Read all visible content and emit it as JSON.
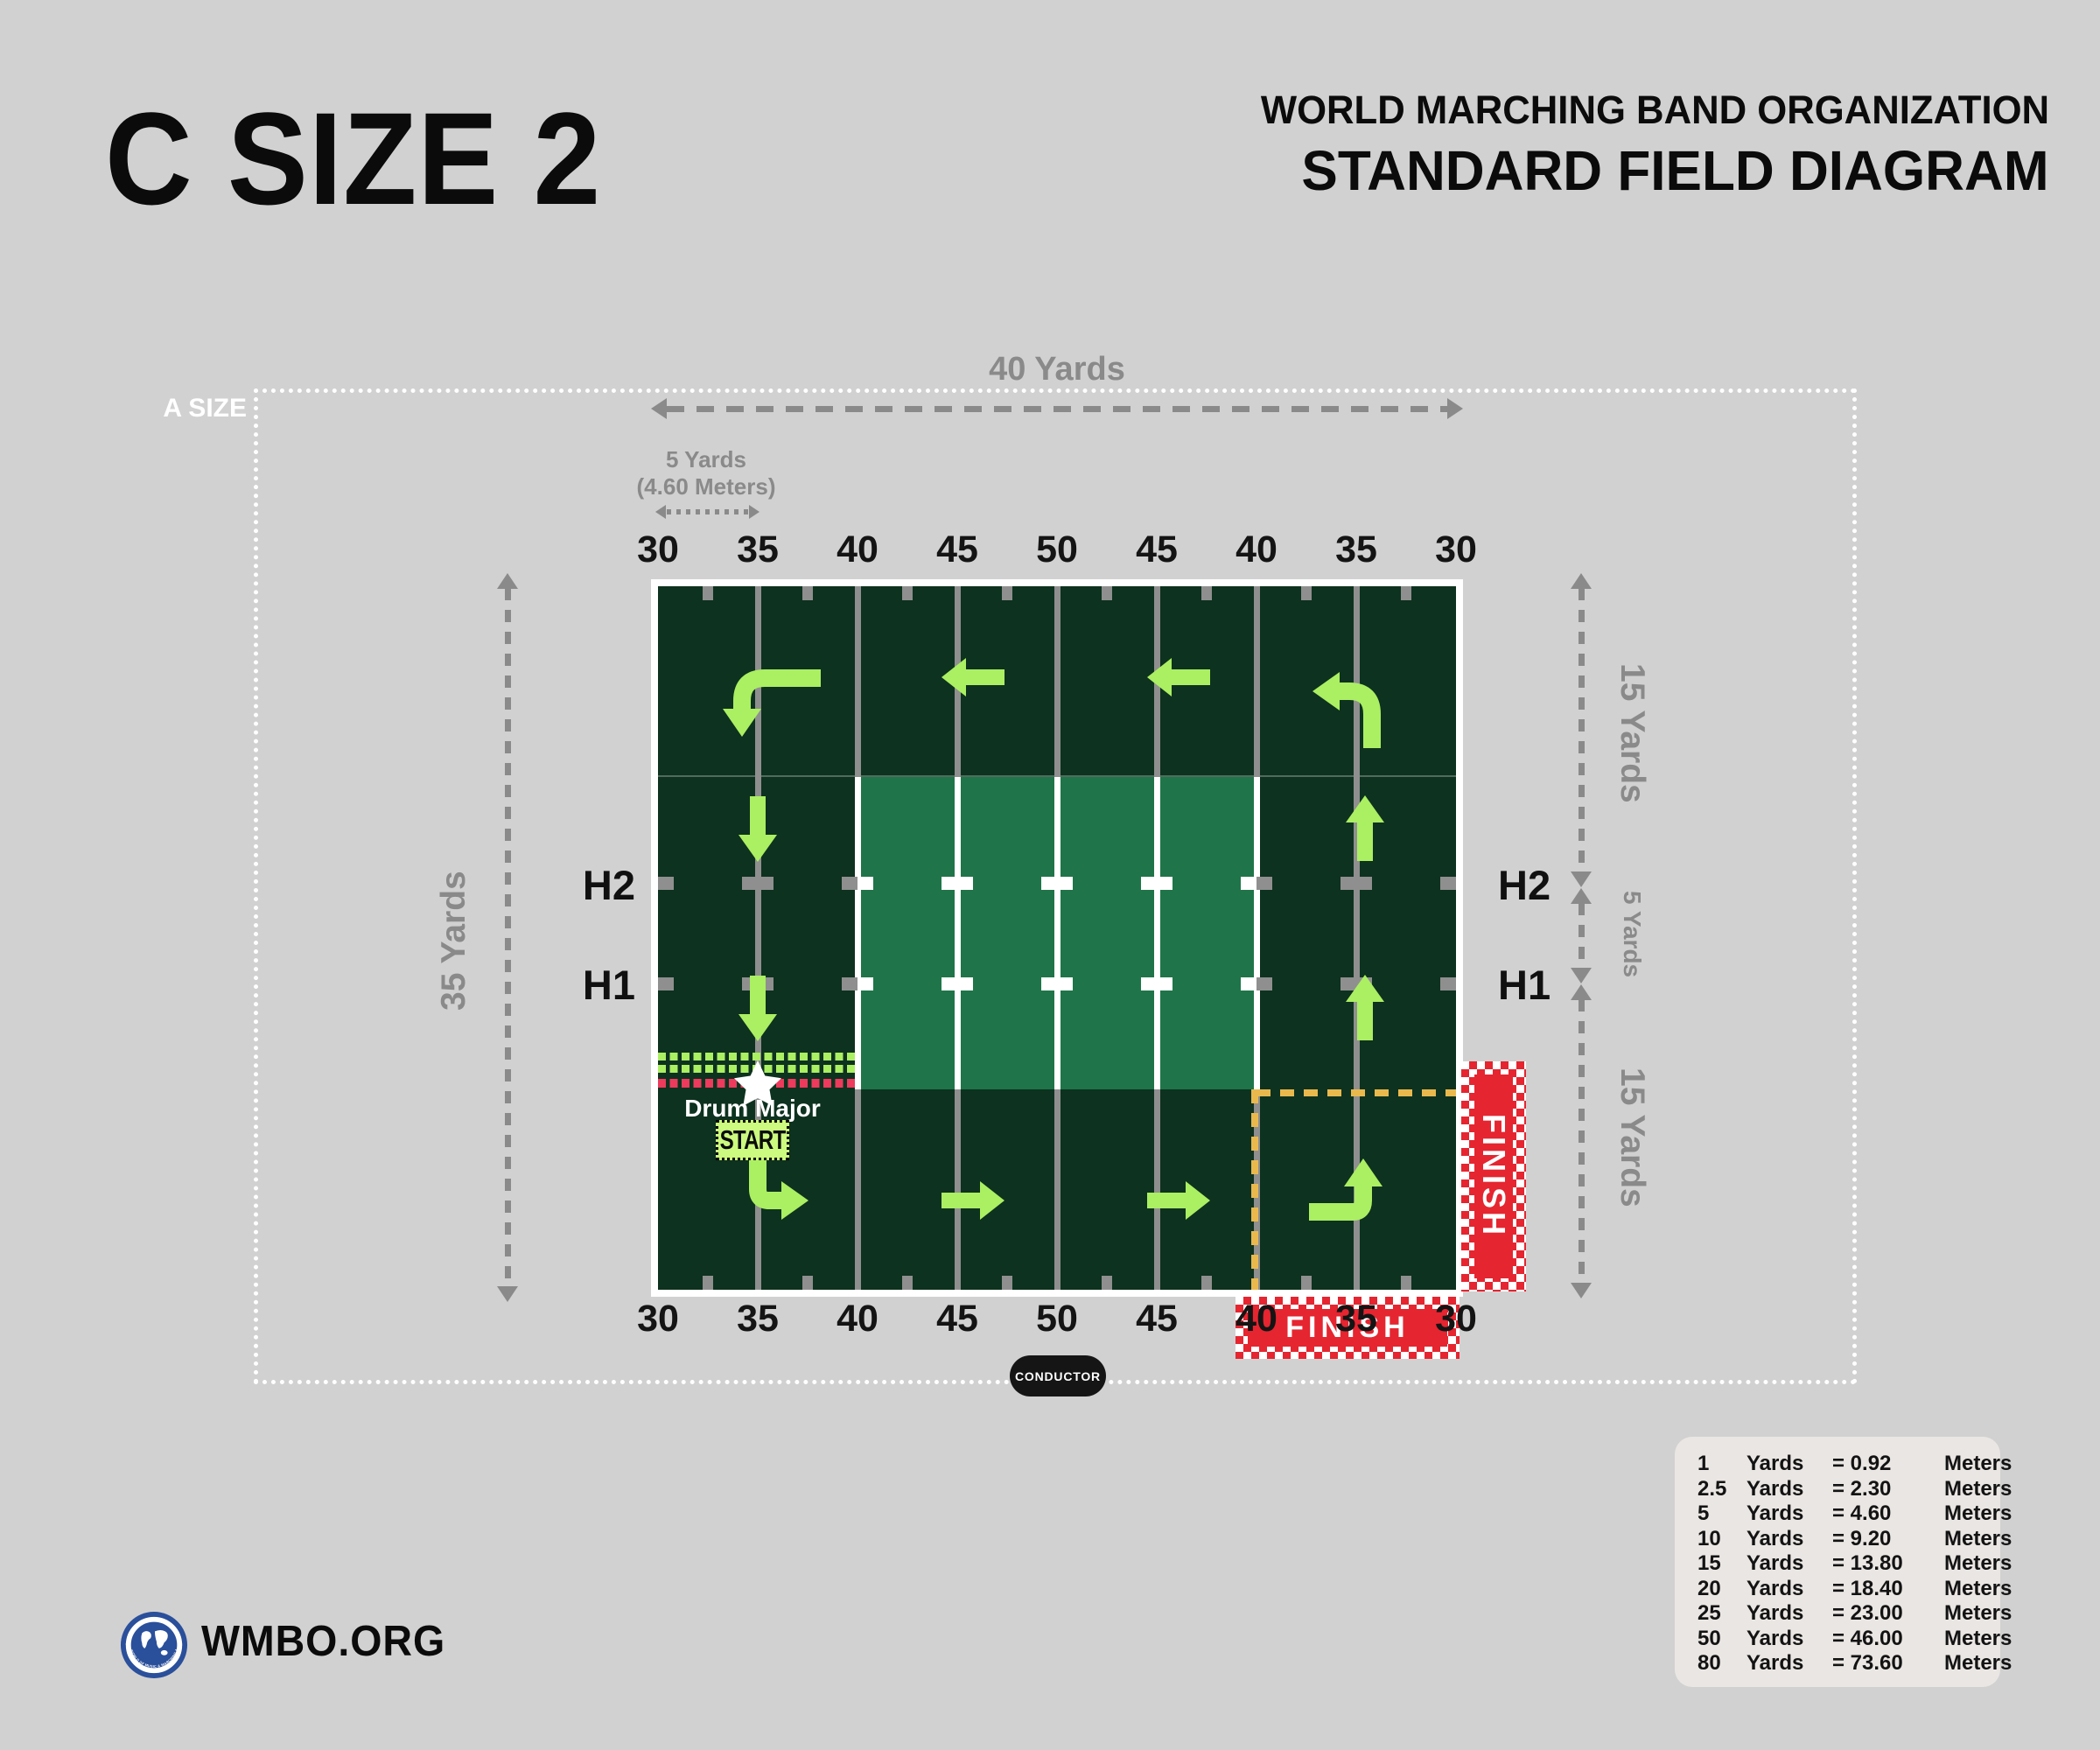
{
  "header": {
    "title": "C SIZE 2",
    "org_line1": "WORLD MARCHING BAND ORGANIZATION",
    "org_line2": "STANDARD FIELD DIAGRAM"
  },
  "a_size_label": "A SIZE",
  "measurements": {
    "top_width": "40 Yards",
    "five_yards_line1": "5 Yards",
    "five_yards_line2": "(4.60 Meters)",
    "left_height": "35 Yards",
    "right_top": "15 Yards",
    "right_mid": "5 Yards",
    "right_bottom": "15 Yards"
  },
  "field": {
    "yard_numbers_top": [
      "30",
      "35",
      "40",
      "45",
      "50",
      "45",
      "40",
      "35",
      "30"
    ],
    "yard_numbers_bottom": [
      "30",
      "35",
      "40",
      "45",
      "50",
      "45",
      "40",
      "35",
      "30"
    ],
    "hash_labels": {
      "left_h2": "H2",
      "left_h1": "H1",
      "right_h2": "H2",
      "right_h1": "H1"
    },
    "drum_major_label": "Drum Major",
    "start_label": "START",
    "finish_side_label": "FINISH",
    "finish_bottom_label": "FINISH",
    "conductor_label": "CONDUCTOR"
  },
  "conversion_table": {
    "rows": [
      {
        "n": "1",
        "u": "Yards",
        "v": "= 0.92",
        "m": "Meters"
      },
      {
        "n": "2.5",
        "u": "Yards",
        "v": "= 2.30",
        "m": "Meters"
      },
      {
        "n": "5",
        "u": "Yards",
        "v": "= 4.60",
        "m": "Meters"
      },
      {
        "n": "10",
        "u": "Yards",
        "v": "= 9.20",
        "m": "Meters"
      },
      {
        "n": "15",
        "u": "Yards",
        "v": "= 13.80",
        "m": "Meters"
      },
      {
        "n": "20",
        "u": "Yards",
        "v": "= 18.40",
        "m": "Meters"
      },
      {
        "n": "25",
        "u": "Yards",
        "v": "= 23.00",
        "m": "Meters"
      },
      {
        "n": "50",
        "u": "Yards",
        "v": "= 46.00",
        "m": "Meters"
      },
      {
        "n": "80",
        "u": "Yards",
        "v": "= 73.60",
        "m": "Meters"
      }
    ]
  },
  "footer": {
    "site": "WMBO.ORG",
    "logo_ring_text_top": "WORLD MARCHING BAND ORGANIZATION",
    "logo_ring_text_bottom": "THE WORLD OF MUSIC & MARCHING ARTS"
  },
  "colors": {
    "page_bg": "#d1d1d1",
    "dark_green": "#0d321f",
    "light_green": "#1f7549",
    "line_gray": "#8f8f8f",
    "guide_gray": "#8a8a8a",
    "accent_green": "#abef62",
    "start_bg": "#ccf97f",
    "strip_red": "#ee3a5c",
    "finish_red": "#e52530",
    "yellow": "#eab94d",
    "panel_bg": "#eae6e3",
    "logo_blue": "#2a4f9b"
  }
}
